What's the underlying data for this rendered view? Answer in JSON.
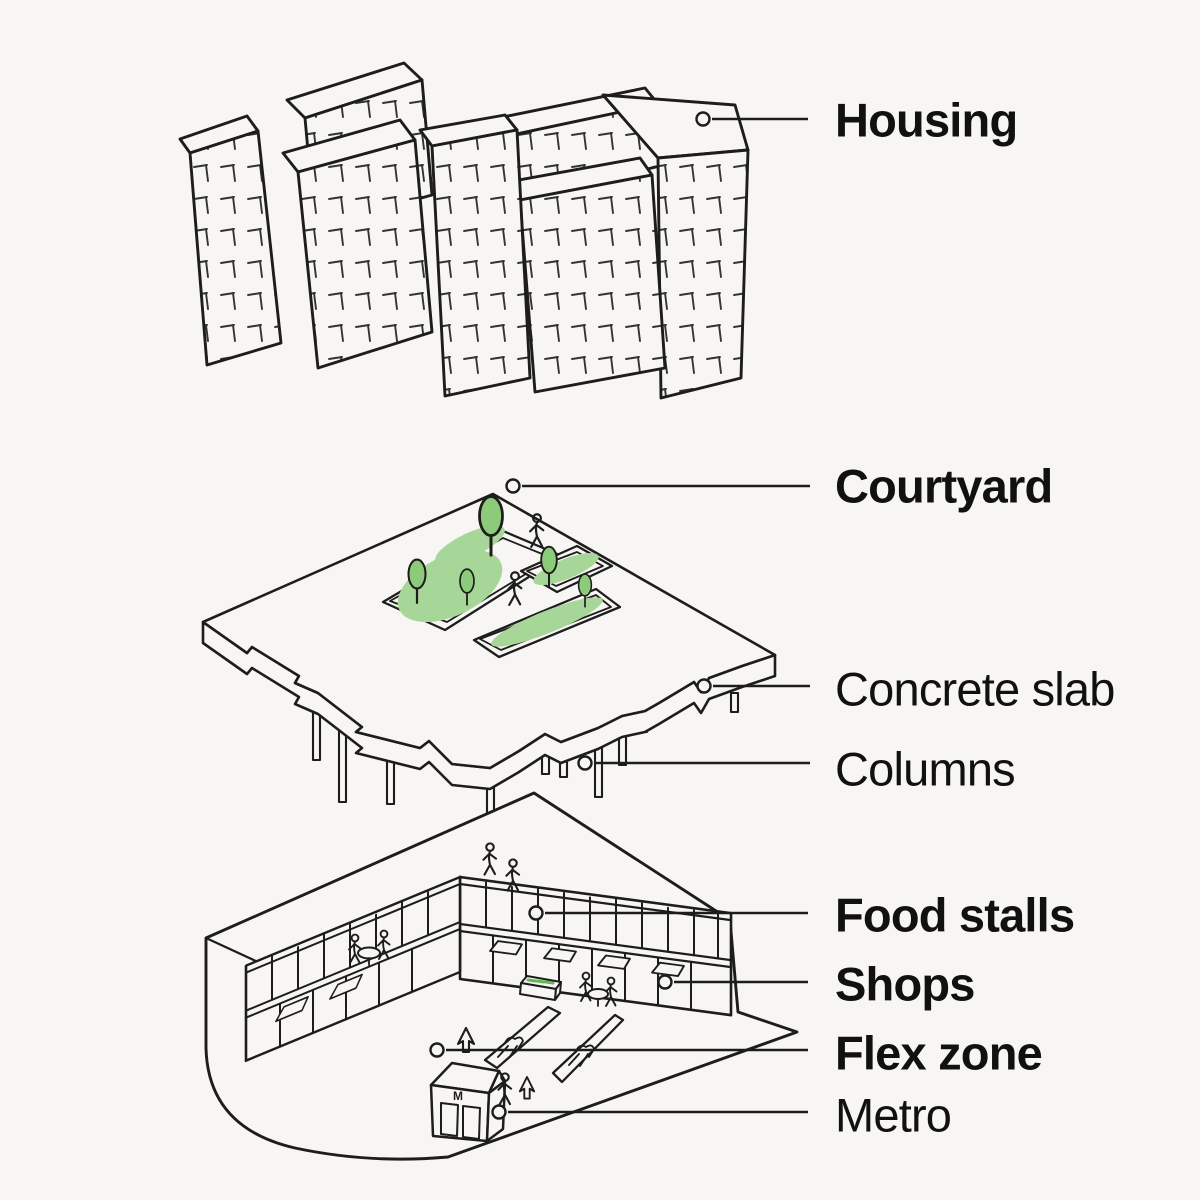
{
  "page": {
    "background": "#f7f6f4",
    "ink": "#1d1d1b"
  },
  "labels": {
    "housing": "Housing",
    "courtyard": "Courtyard",
    "concrete_slab": "Concrete slab",
    "columns": "Columns",
    "food_stalls": "Food stalls",
    "shops": "Shops",
    "flex_zone": "Flex zone",
    "metro": "Metro"
  },
  "metro_sign": "M",
  "colors": {
    "green_patch": "#a7d699",
    "green_tree": "#8ccb79",
    "green_accent": "#5eba4d",
    "ink": "#1d1d1b"
  }
}
